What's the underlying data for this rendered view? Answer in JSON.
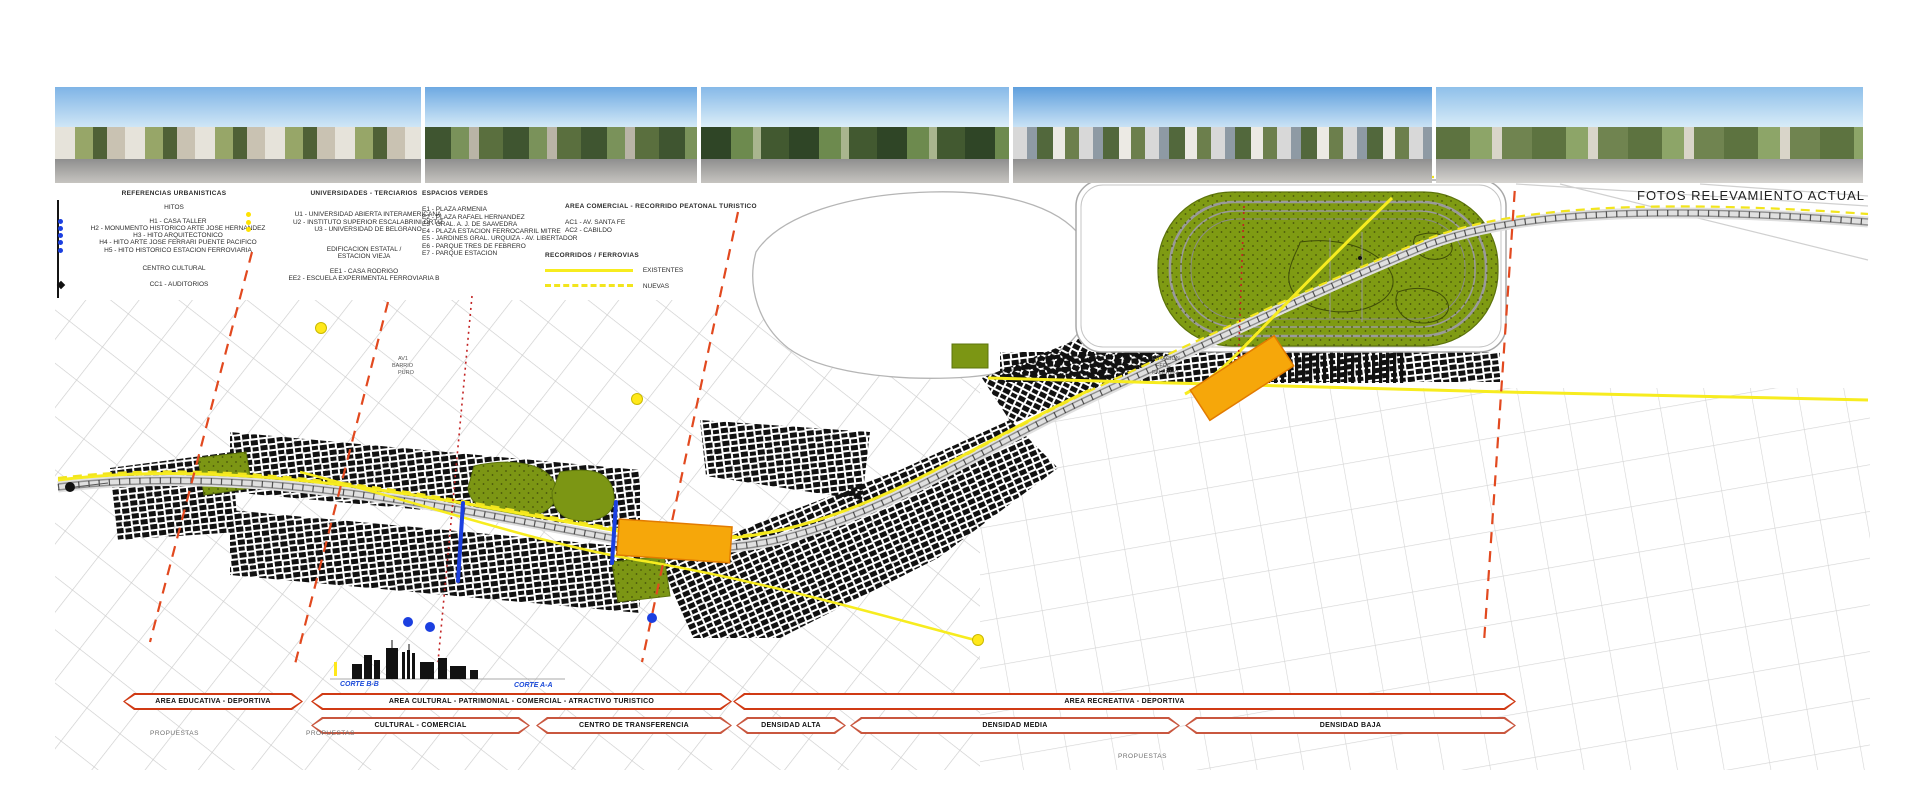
{
  "caption": "FOTOS  RELEVAMIENTO ACTUAL",
  "legend": {
    "col1": {
      "title": "REFERENCIAS URBANISTICAS",
      "subtitle": "HITOS",
      "items": [
        "H1 - CASA TALLER",
        "H2 - MONUMENTO HISTORICO ARTE JOSE HERNANDEZ",
        "H3 - HITO ARQUITECTONICO",
        "H4 - HITO ARTE JOSE FERRARI PUENTE PACIFICO",
        "H5 - HITO HISTORICO ESTACION FERROVIARIA"
      ],
      "subtitle2": "CENTRO CULTURAL",
      "item2": "CC1 - AUDITORIOS"
    },
    "col2": {
      "title": "UNIVERSIDADES - TERCIARIOS",
      "items": [
        "U1 - UNIVERSIDAD ABIERTA INTERAMERICANA",
        "U2 - INSTITUTO SUPERIOR ESCALABRINI ORTIZ",
        "U3 - UNIVERSIDAD DE BELGRANO"
      ],
      "subtitle2a": "EDIFICACION ESTATAL /",
      "subtitle2b": "ESTACION VIEJA",
      "item2a": "EE1 - CASA RODRIGO",
      "item2b": "EE2 - ESCUELA EXPERIMENTAL FERROVIARIA B"
    },
    "col3": {
      "title": "ESPACIOS VERDES",
      "items": [
        "E1 - PLAZA ARMENIA",
        "E2 - PLAZA RAFAEL HERNANDEZ",
        "E3 - GRAL. A. J. DE SAAVEDRA",
        "E4 - PLAZA ESTACION FERROCARRIL MITRE",
        "E5 - JARDINES GRAL. URQUIZA - AV. LIBERTADOR",
        "E6 - PARQUE TRES DE FEBRERO",
        "E7 - PARQUE ESTACION"
      ]
    },
    "col4": {
      "title": "AREA COMERCIAL - RECORRIDO PEATONAL TURISTICO",
      "items": [
        "AC1 - AV. SANTA FE",
        "AC2 - CABILDO"
      ]
    },
    "routes": {
      "title": "RECORRIDOS / FERROVIAS",
      "existing_label": "EXISTENTES",
      "new_label": "NUEVAS"
    }
  },
  "map": {
    "cut_label_b": "CORTE B-B",
    "cut_label_a": "CORTE A-A",
    "proposals_label": "PROPUESTAS",
    "station_label": {
      "l1": "ESTACION",
      "l2": "FFCC",
      "l3": "PALERMO"
    },
    "area_label": {
      "l1": "AV1",
      "l2": "BARRIO",
      "l3": "PURO"
    },
    "colors": {
      "banner_red": "#d03a14",
      "rail_yellow": "#f7ec1f",
      "intervention_orange": "#f6a70a",
      "park_green": "#7f9b13",
      "marker_blue": "#1b3fe0",
      "hint_red_dashed": "#e2491f",
      "cut_label_blue": "#1a49d8"
    }
  },
  "banners": {
    "row1": [
      {
        "label": "AREA EDUCATIVA - DEPORTIVA"
      },
      {
        "label": "AREA CULTURAL - PATRIMONIAL - COMERCIAL - ATRACTIVO TURISTICO"
      },
      {
        "label": "AREA RECREATIVA - DEPORTIVA"
      }
    ],
    "row2": [
      {
        "label": "CULTURAL - COMERCIAL"
      },
      {
        "label": "CENTRO DE TRANSFERENCIA"
      },
      {
        "label": "DENSIDAD ALTA"
      },
      {
        "label": "DENSIDAD MEDIA"
      },
      {
        "label": "DENSIDAD BAJA"
      }
    ]
  }
}
